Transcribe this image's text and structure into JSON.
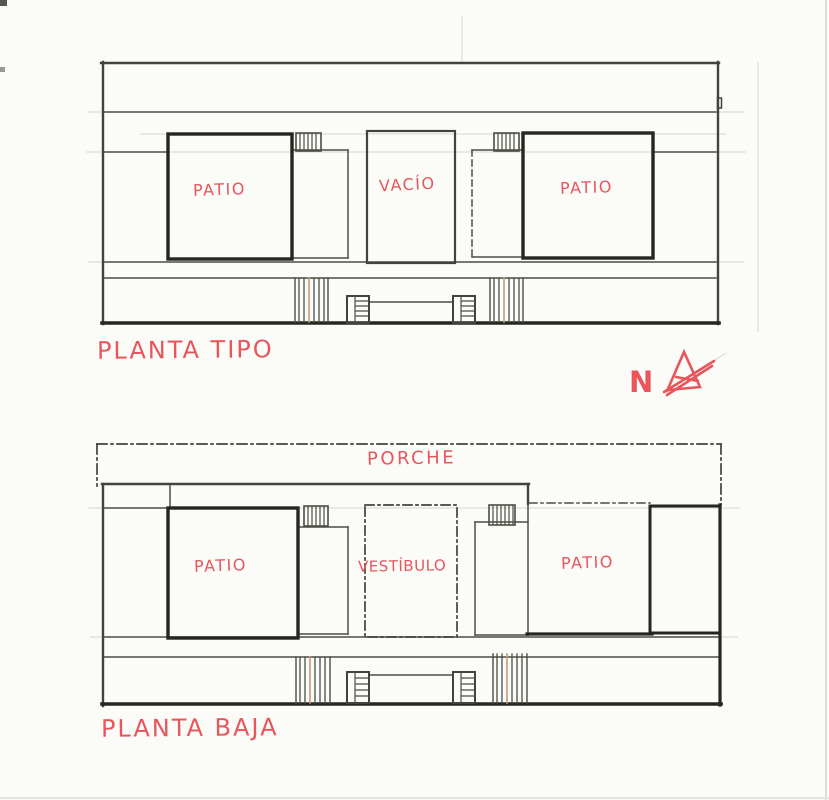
{
  "colors": {
    "paper": "#fbfbf8",
    "ink": "#41443c",
    "ink_heavy": "#24271f",
    "red_ink": "#e8565c",
    "pencil_faint": "#d8d6cc",
    "pencil_tan": "#c59b79"
  },
  "plans": {
    "planta_tipo": {
      "title": "PLANTA TIPO",
      "left_patio_label": "PATIO",
      "void_label": "VACÍO",
      "right_patio_label": "PATIO"
    },
    "planta_baja": {
      "title": "PLANTA BAJA",
      "porch_label": "PORCHE",
      "left_patio_label": "PATIO",
      "vestibule_label": "VESTÍBULO",
      "right_patio_label": "PATIO"
    }
  },
  "compass": {
    "north_label": "N"
  }
}
